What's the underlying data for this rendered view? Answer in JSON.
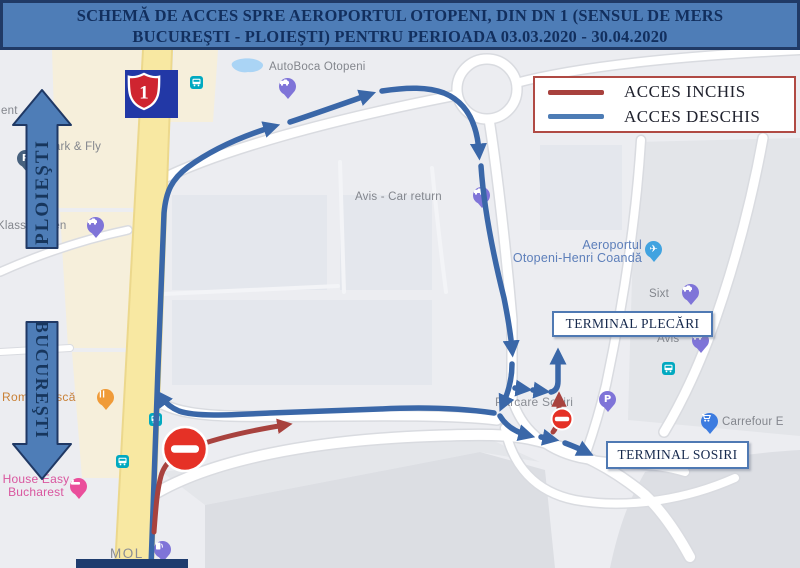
{
  "title": {
    "line1": "SCHEMĂ DE ACCES SPRE AEROPORTUL OTOPENI, DIN DN 1 (SENSUL DE MERS",
    "line2": "BUCUREŞTI - PLOIEŞTI) PENTRU PERIOADA 03.03.2020 - 30.04.2020"
  },
  "legend": {
    "closed_label": "ACCES INCHIS",
    "open_label": "ACCES DESCHIS",
    "closed_color": "#a8413d",
    "open_color": "#4d7cb5"
  },
  "directions": {
    "north": "PLOIEŞTI",
    "south": "BUCUREŞTI"
  },
  "route_shield": {
    "number": "1"
  },
  "terminals": {
    "plecari": "TERMINAL PLECĂRI",
    "sosiri": "TERMINAL SOSIRI"
  },
  "map_labels": {
    "ent": "ent",
    "park_fly": "Park & Fly",
    "klass_wagen": "Klass Wagen",
    "autoboca": "AutoBoca Otopeni",
    "avis_return": "Avis - Car return",
    "airport_line1": "Aeroportul",
    "airport_line2": "Otopeni-Henri Coandă",
    "sixt": "Sixt",
    "avis": "Avis",
    "carrefour": "Carrefour E",
    "parcare_sosiri": "Parcare Sosiri",
    "romaneasca": "Românească",
    "house_easy_line1": "House Easy",
    "house_easy_line2": "Bucharest",
    "mol": "MOL"
  }
}
